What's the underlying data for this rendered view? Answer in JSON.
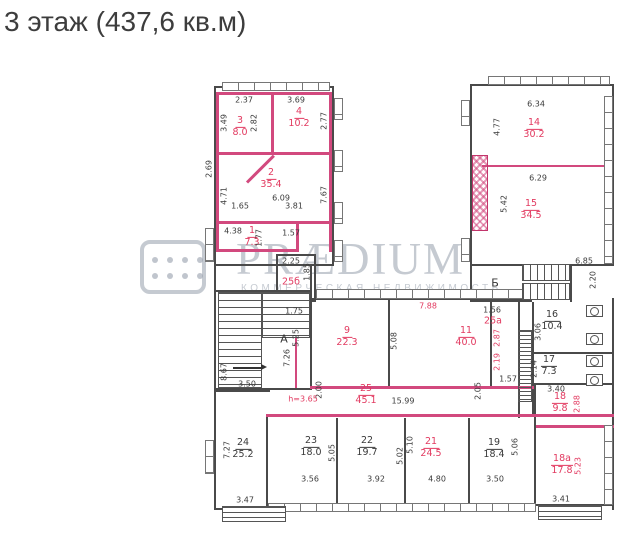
{
  "title": "3 этаж (437,6 кв.м)",
  "watermark": {
    "brand": "PRÆDIUM",
    "tagline": "КОММЕРЧЕСКАЯ НЕДВИЖИМОСТЬ",
    "logo": "dots-grid-icon"
  },
  "colors": {
    "highlight_wall": "#d2497e",
    "highlight_text": "#e23a60",
    "wall": "#4a4a4a",
    "text": "#3a3a3a",
    "watermark": "#969eac",
    "title": "#3d3d3d"
  },
  "stairwells": [
    {
      "label": "А"
    },
    {
      "label": "Б"
    }
  ],
  "ceiling_note": "h=3.65",
  "rooms": [
    {
      "number": "1",
      "area": "7.3",
      "highlighted": true
    },
    {
      "number": "2",
      "area": "35.4",
      "highlighted": true
    },
    {
      "number": "3",
      "area": "8.0",
      "highlighted": true
    },
    {
      "number": "4",
      "area": "10.2",
      "highlighted": true
    },
    {
      "number": "25б",
      "area": null,
      "highlighted": true
    },
    {
      "number": "9",
      "area": "22.3",
      "highlighted": true
    },
    {
      "number": "11",
      "area": "40.0",
      "highlighted": true
    },
    {
      "number": "14",
      "area": "30.2",
      "highlighted": true
    },
    {
      "number": "15",
      "area": "34.5",
      "highlighted": true
    },
    {
      "number": "16",
      "area": "10.4",
      "highlighted": false
    },
    {
      "number": "17",
      "area": "7.3",
      "highlighted": false
    },
    {
      "number": "18",
      "area": "9.8",
      "highlighted": true
    },
    {
      "number": "18а",
      "area": "17.8",
      "highlighted": true
    },
    {
      "number": "19",
      "area": "18.4",
      "highlighted": false
    },
    {
      "number": "21",
      "area": "24.5",
      "highlighted": true
    },
    {
      "number": "22",
      "area": "19.7",
      "highlighted": false
    },
    {
      "number": "23",
      "area": "18.0",
      "highlighted": false
    },
    {
      "number": "24",
      "area": "25.2",
      "highlighted": false
    },
    {
      "number": "25",
      "area": "45.1",
      "highlighted": true
    },
    {
      "number": "25а",
      "area": null,
      "highlighted": true
    }
  ],
  "dims": [
    {
      "text": "2.37",
      "red": false,
      "v": false
    },
    {
      "text": "3.69",
      "red": false,
      "v": false
    },
    {
      "text": "3.49",
      "red": false,
      "v": true
    },
    {
      "text": "2.82",
      "red": false,
      "v": true
    },
    {
      "text": "2.77",
      "red": false,
      "v": true
    },
    {
      "text": "1.65",
      "red": false,
      "v": false
    },
    {
      "text": "3.81",
      "red": false,
      "v": false
    },
    {
      "text": "2.69",
      "red": false,
      "v": true
    },
    {
      "text": "4.71",
      "red": false,
      "v": true
    },
    {
      "text": "7.67",
      "red": false,
      "v": true
    },
    {
      "text": "6.09",
      "red": false,
      "v": false
    },
    {
      "text": "4.38",
      "red": false,
      "v": false
    },
    {
      "text": "1.77",
      "red": false,
      "v": true
    },
    {
      "text": "1.57",
      "red": false,
      "v": false
    },
    {
      "text": "2.25",
      "red": false,
      "v": false
    },
    {
      "text": "1.85",
      "red": false,
      "v": true
    },
    {
      "text": "6.34",
      "red": false,
      "v": false
    },
    {
      "text": "4.77",
      "red": false,
      "v": true
    },
    {
      "text": "6.29",
      "red": false,
      "v": false
    },
    {
      "text": "5.42",
      "red": false,
      "v": true
    },
    {
      "text": "6.85",
      "red": false,
      "v": false
    },
    {
      "text": "2.20",
      "red": false,
      "v": true
    },
    {
      "text": "1.75",
      "red": false,
      "v": false
    },
    {
      "text": "5.25",
      "red": false,
      "v": true
    },
    {
      "text": "7.26",
      "red": false,
      "v": true
    },
    {
      "text": "5.08",
      "red": false,
      "v": true
    },
    {
      "text": "7.88",
      "red": true,
      "v": false
    },
    {
      "text": "1.56",
      "red": false,
      "v": false
    },
    {
      "text": "2.87",
      "red": true,
      "v": true
    },
    {
      "text": "2.19",
      "red": true,
      "v": true
    },
    {
      "text": "1.57",
      "red": false,
      "v": false
    },
    {
      "text": "2.05",
      "red": false,
      "v": true
    },
    {
      "text": "3.06",
      "red": false,
      "v": true
    },
    {
      "text": "2.14",
      "red": false,
      "v": true
    },
    {
      "text": "3.40",
      "red": false,
      "v": false
    },
    {
      "text": "2.88",
      "red": true,
      "v": true
    },
    {
      "text": "8.67",
      "red": false,
      "v": true
    },
    {
      "text": "3.50",
      "red": false,
      "v": false
    },
    {
      "text": "2.00",
      "red": false,
      "v": true
    },
    {
      "text": "15.99",
      "red": false,
      "v": false
    },
    {
      "text": "7.27",
      "red": false,
      "v": true
    },
    {
      "text": "3.47",
      "red": false,
      "v": false
    },
    {
      "text": "5.05",
      "red": false,
      "v": true
    },
    {
      "text": "3.56",
      "red": false,
      "v": false
    },
    {
      "text": "5.02",
      "red": false,
      "v": true
    },
    {
      "text": "3.92",
      "red": false,
      "v": false
    },
    {
      "text": "5.10",
      "red": false,
      "v": true
    },
    {
      "text": "4.80",
      "red": false,
      "v": false
    },
    {
      "text": "5.06",
      "red": false,
      "v": true
    },
    {
      "text": "3.50",
      "red": false,
      "v": false
    },
    {
      "text": "5.23",
      "red": true,
      "v": true
    },
    {
      "text": "3.41",
      "red": false,
      "v": false
    }
  ]
}
